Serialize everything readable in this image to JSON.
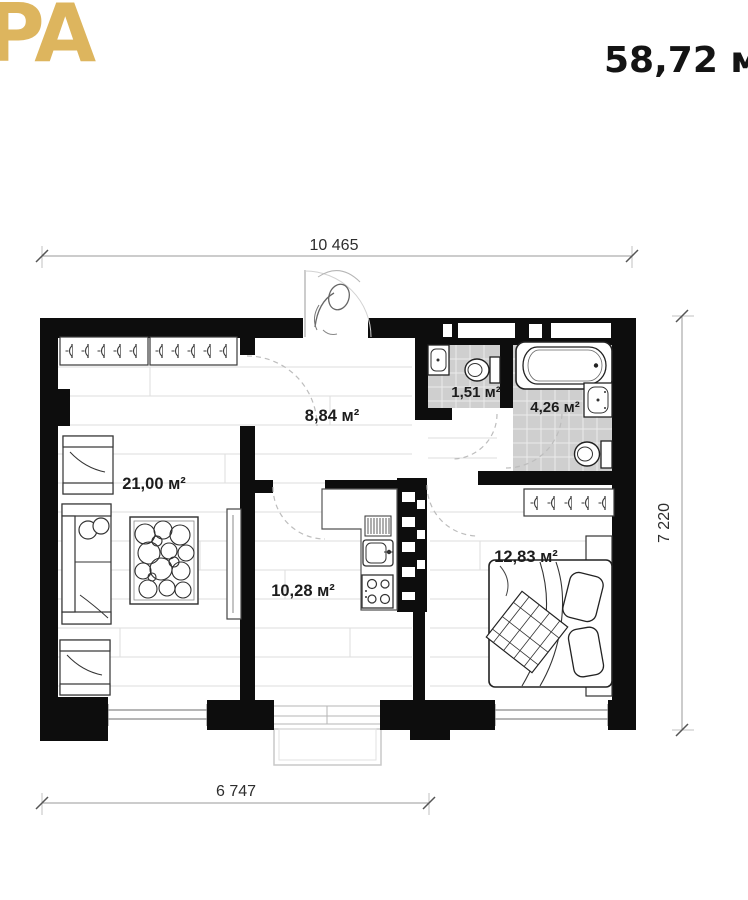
{
  "header": {
    "logo_text": "PA",
    "total_area": "58,72 м"
  },
  "plan": {
    "dimensions": {
      "top": "10 465",
      "right": "7 220",
      "bottom": "6 747"
    },
    "rooms": [
      {
        "id": "living-room",
        "area": "21,00 м²"
      },
      {
        "id": "hallway",
        "area": "8,84 м²"
      },
      {
        "id": "wc",
        "area": "1,51 м²"
      },
      {
        "id": "bathroom",
        "area": "4,26 м²"
      },
      {
        "id": "kitchen",
        "area": "10,28 м²"
      },
      {
        "id": "bedroom",
        "area": "12,83 м²"
      }
    ],
    "fixtures": [
      "wardrobe-hangers",
      "bathtub",
      "toilet",
      "washbasin",
      "kitchen-sink",
      "stove",
      "dish-rack",
      "bed",
      "sofa",
      "armchair",
      "rug",
      "tv-stand",
      "balcony",
      "entrance-person-sketch"
    ]
  },
  "colors": {
    "accent_gold": "#ddb55e",
    "wall": "#0d0d0d",
    "tile": "#cfcfcf"
  }
}
